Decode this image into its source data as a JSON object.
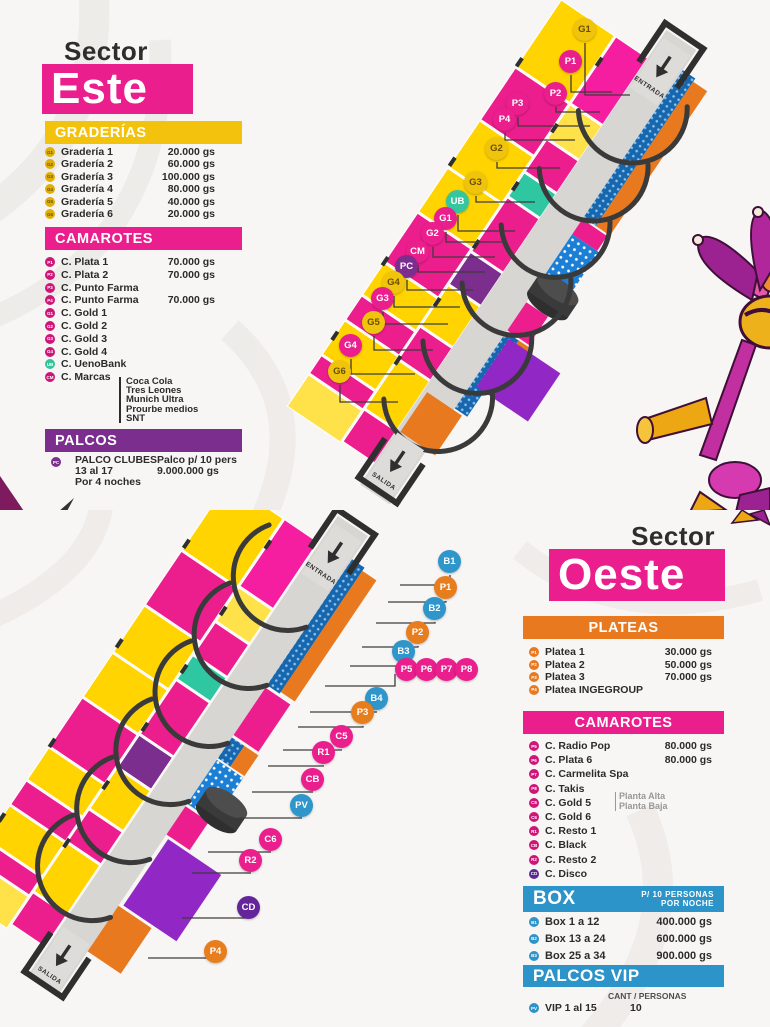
{
  "palette": {
    "magenta": "#ea1e8c",
    "yellow": "#f2c20d",
    "purple": "#7c2e8f",
    "orange": "#e8791f",
    "blue": "#2d94c9",
    "teal": "#36c39c",
    "dark_purple": "#5b2a91",
    "runway_gray": "#d7d6d3",
    "dark": "#2f2f2f",
    "text": "#2c2b2a"
  },
  "este": {
    "sector_label": "Sector",
    "sector_name": "Este",
    "map": {
      "entrance_label": "ENTRADA",
      "exit_label": "SALIDA",
      "labels": [
        "G1",
        "P1",
        "P2",
        "P3",
        "P4",
        "G2",
        "G3",
        "UB",
        "G1",
        "G2",
        "CM",
        "PC",
        "G4",
        "G3",
        "G5",
        "G4",
        "G6"
      ]
    },
    "graderias": {
      "header": "GRADERÍAS",
      "items": [
        {
          "code": "G1",
          "name": "Gradería 1",
          "price": "20.000 gs"
        },
        {
          "code": "G2",
          "name": "Gradería 2",
          "price": "60.000 gs"
        },
        {
          "code": "G3",
          "name": "Gradería 3",
          "price": "100.000 gs"
        },
        {
          "code": "G4",
          "name": "Gradería 4",
          "price": "80.000 gs"
        },
        {
          "code": "G5",
          "name": "Gradería 5",
          "price": "40.000 gs"
        },
        {
          "code": "G6",
          "name": "Gradería 6",
          "price": "20.000 gs"
        }
      ]
    },
    "camarotes": {
      "header": "CAMAROTES",
      "items": [
        {
          "code": "P1",
          "name": "C. Plata 1",
          "price": "70.000 gs"
        },
        {
          "code": "P2",
          "name": "C. Plata 2",
          "price": "70.000 gs"
        },
        {
          "code": "P3",
          "name": "C. Punto Farma",
          "price": ""
        },
        {
          "code": "P4",
          "name": "C. Punto Farma",
          "price": "70.000 gs"
        },
        {
          "code": "G1",
          "name": "C. Gold 1",
          "price": ""
        },
        {
          "code": "G2",
          "name": "C. Gold 2",
          "price": ""
        },
        {
          "code": "G3",
          "name": "C. Gold 3",
          "price": ""
        },
        {
          "code": "G4",
          "name": "C. Gold 4",
          "price": ""
        },
        {
          "code": "UB",
          "name": "C. UenoBank",
          "price": ""
        },
        {
          "code": "CM",
          "name": "C. Marcas",
          "price": ""
        }
      ],
      "marcas_brands": [
        "Coca Cola",
        "Tres Leones",
        "Munich Ultra",
        "Prourbe medios",
        "SNT"
      ]
    },
    "palcos": {
      "header": "PALCOS",
      "code": "PC",
      "name_line1": "PALCO CLUBES",
      "name_line2": "13 al 17",
      "name_line3": "Por 4 noches",
      "detail_line1": "Palco p/ 10 pers",
      "detail_line2": "9.000.000 gs"
    }
  },
  "oeste": {
    "sector_label": "Sector",
    "sector_name": "Oeste",
    "map": {
      "entrance_label": "ENTRADA",
      "exit_label": "SALIDA",
      "labels": [
        "B1",
        "P1",
        "B2",
        "P2",
        "B3",
        "P5",
        "P6",
        "P7",
        "P8",
        "B4",
        "P3",
        "C5",
        "R1",
        "CB",
        "PV",
        "C6",
        "R2",
        "CD",
        "P4"
      ]
    },
    "plateas": {
      "header": "PLATEAS",
      "items": [
        {
          "code": "P1",
          "name": "Platea 1",
          "price": "30.000 gs"
        },
        {
          "code": "P2",
          "name": "Platea 2",
          "price": "50.000 gs"
        },
        {
          "code": "P3",
          "name": "Platea 3",
          "price": "70.000 gs"
        },
        {
          "code": "P4",
          "name": "Platea INGEGROUP",
          "price": ""
        }
      ]
    },
    "camarotes": {
      "header": "CAMAROTES",
      "items": [
        {
          "code": "P5",
          "name": "C. Radio Pop",
          "price": "80.000 gs"
        },
        {
          "code": "P6",
          "name": "C. Plata 6",
          "price": "80.000 gs"
        },
        {
          "code": "P7",
          "name": "C. Carmelita Spa",
          "price": ""
        },
        {
          "code": "P8",
          "name": "C. Takis",
          "price": ""
        },
        {
          "code": "C5",
          "name": "C. Gold 5",
          "price": ""
        },
        {
          "code": "C6",
          "name": "C. Gold 6",
          "price": ""
        },
        {
          "code": "R1",
          "name": "C. Resto 1",
          "price": ""
        },
        {
          "code": "CB",
          "name": "C. Black",
          "price": ""
        },
        {
          "code": "R2",
          "name": "C. Resto 2",
          "price": ""
        },
        {
          "code": "CD",
          "name": "C. Disco",
          "price": ""
        }
      ],
      "gold5_note_line1": "Planta Alta",
      "gold5_note_line2": "Planta Baja"
    },
    "box": {
      "header": "BOX",
      "note_line1": "P/ 10 PERSONAS",
      "note_line2": "POR NOCHE",
      "items": [
        {
          "code": "B1",
          "name": "Box 1 a 12",
          "price": "400.000 gs"
        },
        {
          "code": "B2",
          "name": "Box 13 a 24",
          "price": "600.000 gs"
        },
        {
          "code": "B3",
          "name": "Box 25 a 34",
          "price": "900.000 gs"
        }
      ]
    },
    "palcos_vip": {
      "header": "PALCOS VIP",
      "columns_label": "CANT / PERSONAS",
      "code": "PV",
      "name": "VIP 1 al 15",
      "value": "10"
    }
  }
}
